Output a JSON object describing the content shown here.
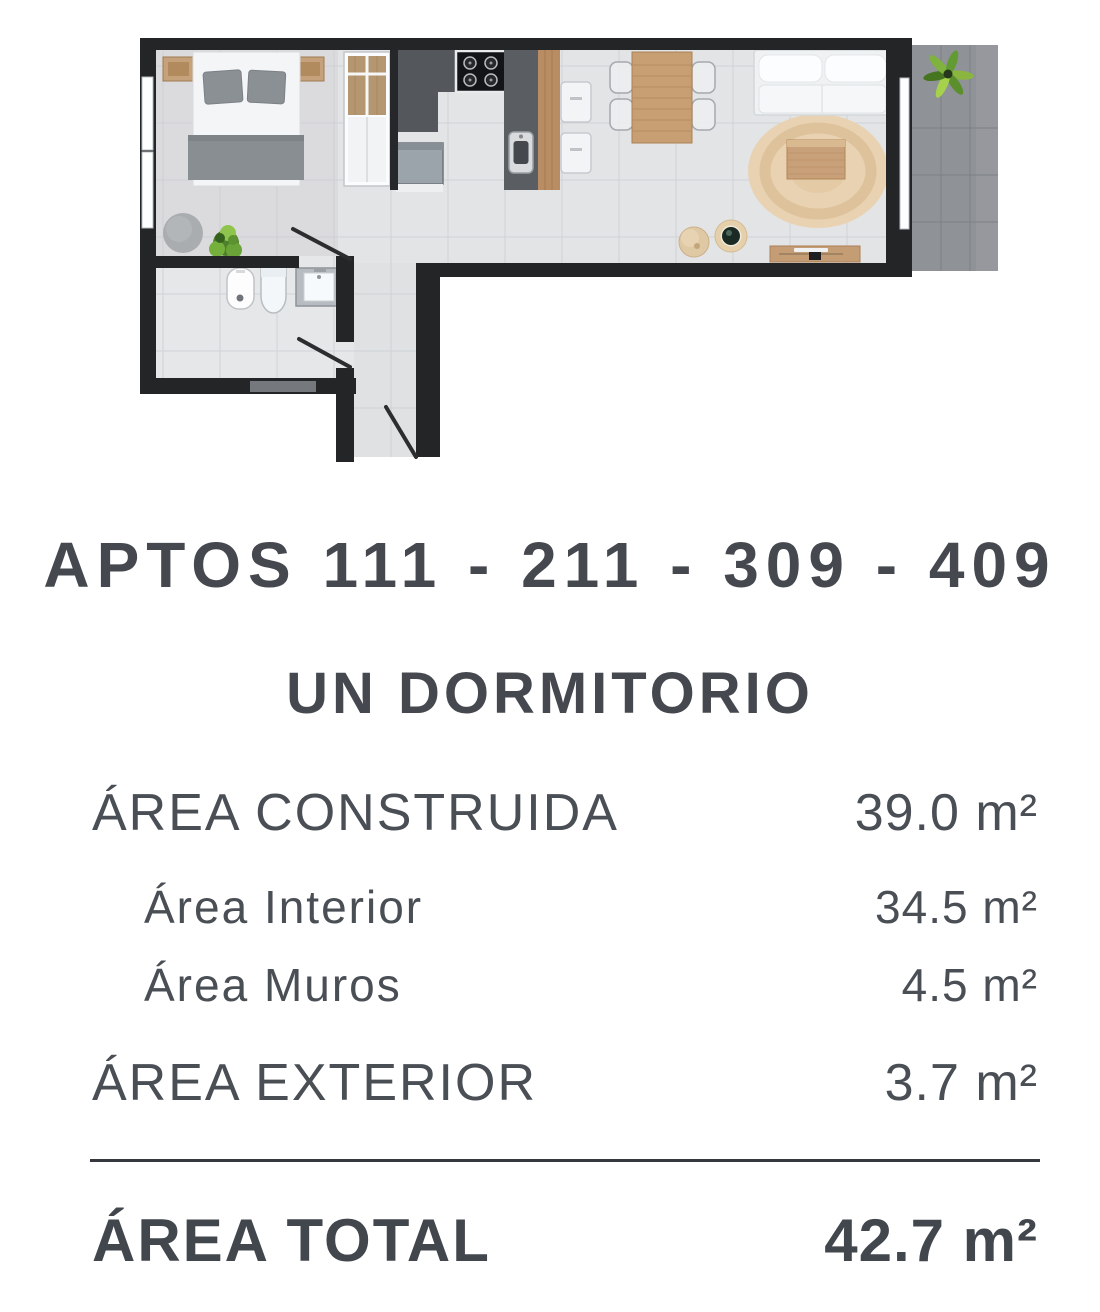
{
  "header": {
    "title": "APTOS 111 - 211 - 309 - 409",
    "subtitle": "UN DORMITORIO"
  },
  "area_table": {
    "rows": [
      {
        "label": "ÁREA CONSTRUIDA",
        "value": "39.0 m²"
      },
      {
        "label": "Área Interior",
        "value": "34.5 m²"
      },
      {
        "label": "Área Muros",
        "value": "4.5 m²"
      },
      {
        "label": "ÁREA EXTERIOR",
        "value": "3.7 m²"
      }
    ],
    "total": {
      "label": "ÁREA TOTAL",
      "value": "42.7 m²"
    }
  },
  "floorplan": {
    "type": "one-bedroom apartment, top view",
    "furniture": [
      "double-bed",
      "nightstands",
      "gray-pillows",
      "bench-blanket",
      "round-pouf",
      "plant",
      "wardrobe",
      "stove",
      "washer",
      "kitchen-island-sink",
      "wood-counter",
      "stools",
      "dining-table",
      "chairs",
      "sofa",
      "round-jute-rug",
      "coffee-table",
      "floor-poufs",
      "tv-console",
      "bidet",
      "toilet",
      "vanity-sink",
      "entry-door",
      "terrace-plant"
    ],
    "colors": {
      "wall": "#232527",
      "floor": "#e3e4e6",
      "wood": "#c49a6c",
      "kitchen_dark": "#54575c",
      "terrace": "#8f9297",
      "rug": "#e9d2b1",
      "plant_green": "#6fa83c",
      "text": "#484c53"
    }
  }
}
